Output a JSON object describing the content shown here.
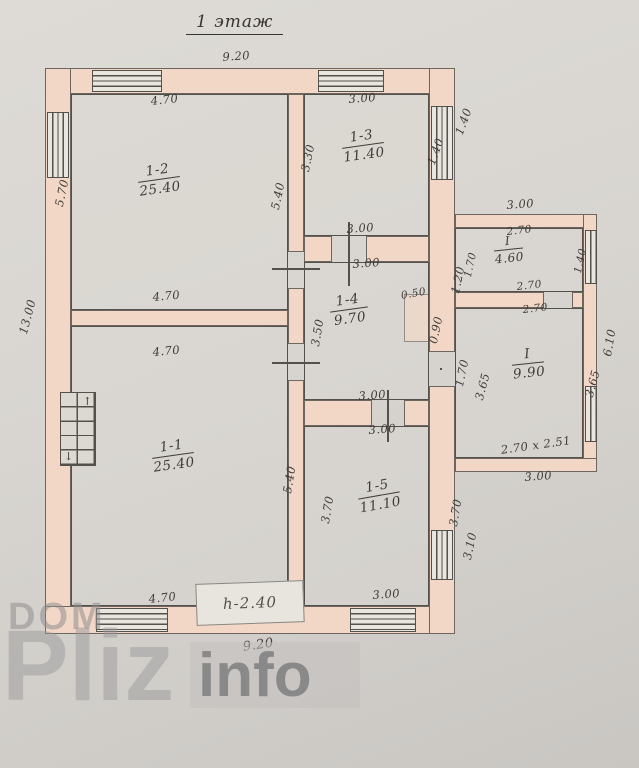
{
  "title": "1 этаж",
  "floor_plan": {
    "rooms": [
      {
        "number": "1-2",
        "area": "25.40"
      },
      {
        "number": "1-3",
        "area": "11.40"
      },
      {
        "number": "1-4",
        "area": "9.70"
      },
      {
        "number": "1-1",
        "area": "25.40"
      },
      {
        "number": "1-5",
        "area": "11.10"
      },
      {
        "number": "I",
        "area": "4.60"
      },
      {
        "number": "I",
        "area": "9.90"
      }
    ],
    "dims": [
      "9.20",
      "4.70",
      "3.00",
      "5.70",
      "5.40",
      "3.30",
      "1.40",
      "1.40",
      "4.70",
      "3.00",
      "3.00",
      "1.20",
      "0.50",
      "0.90",
      "3.50",
      "3.00",
      "1.70",
      "4.70",
      "5.40",
      "4.70",
      "3.00",
      "3.70",
      "3.70",
      "3.10",
      "3.00",
      "9.20",
      "13.00",
      "3.00",
      "2.70",
      "2.70",
      "2.70",
      "1.70",
      "1.40",
      "3.65",
      "3.65",
      "6.10",
      "2.70 х 2.51",
      "3.00"
    ],
    "height_note": "h-2.40",
    "stove": {
      "up": "↑",
      "down": "↓"
    }
  },
  "watermark": {
    "dom": "DOM",
    "pliz": "Pliz",
    "info": "info"
  },
  "colors": {
    "wall_fill": "#f2d7c6",
    "line": "#54504b",
    "paper": "#d8d5d0",
    "ink": "#3f3b38"
  }
}
